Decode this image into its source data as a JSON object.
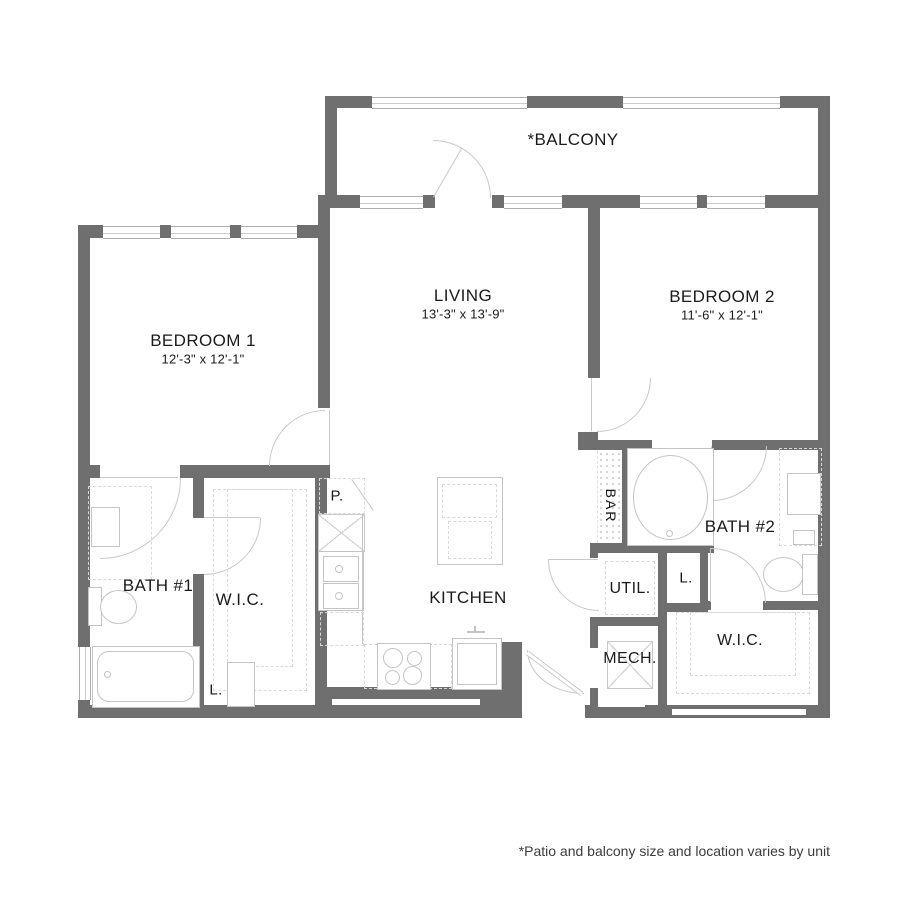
{
  "rooms": {
    "balcony": {
      "label": "*BALCONY"
    },
    "living": {
      "label": "LIVING",
      "dims": "13'-3\" x 13'-9\""
    },
    "bedroom2": {
      "label": "BEDROOM 2",
      "dims": "11'-6\" x 12'-1\""
    },
    "bedroom1": {
      "label": "BEDROOM 1",
      "dims": "12'-3\" x 12'-1\""
    },
    "bath1": {
      "label": "BATH #1"
    },
    "wic1": {
      "label": "W.I.C."
    },
    "linen1": {
      "label": "L."
    },
    "pantry": {
      "label": "P."
    },
    "kitchen": {
      "label": "KITCHEN"
    },
    "bar": {
      "label": "BAR"
    },
    "bath2": {
      "label": "BATH #2"
    },
    "util": {
      "label": "UTIL."
    },
    "linen2": {
      "label": "L."
    },
    "mech": {
      "label": "MECH."
    },
    "wic2": {
      "label": "W.I.C."
    }
  },
  "footnote": "*Patio and balcony size and location varies by unit",
  "colors": {
    "wall": "#6f6f6f",
    "fixture_line": "#c4c4c4",
    "text": "#1b1b1b"
  }
}
